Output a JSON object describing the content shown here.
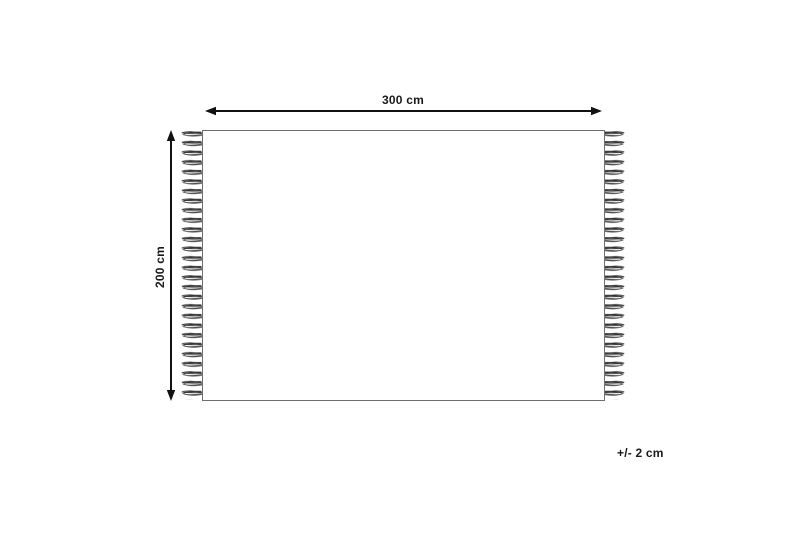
{
  "diagram": {
    "type": "product-dimension-diagram",
    "subject": "rug with fringe tassels on left and right edges",
    "width_label": "300 cm",
    "height_label": "200 cm",
    "tolerance_label": "+/- 2 cm",
    "width_cm": 300,
    "height_cm": 200,
    "tolerance_cm": 2
  },
  "colors": {
    "background": "#ffffff",
    "arrow": "#111111",
    "rug_outline": "#6e6e6e",
    "fringe": "#404040",
    "text": "#1a1a1a"
  }
}
